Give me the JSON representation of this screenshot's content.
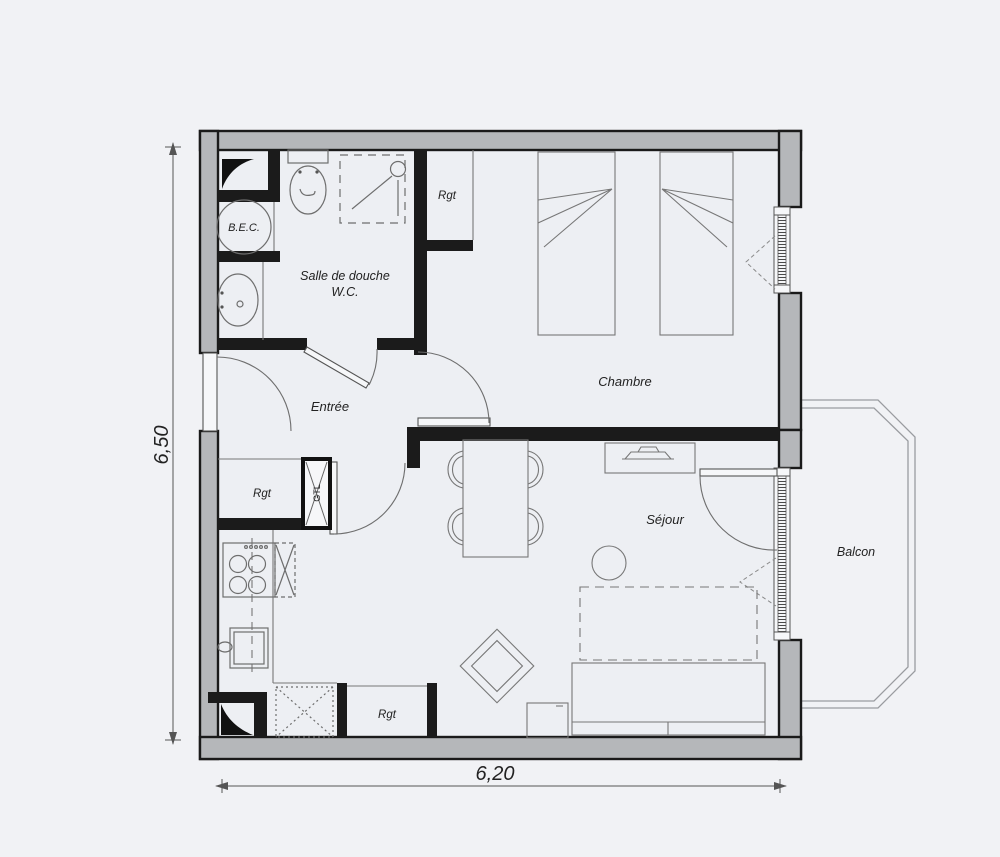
{
  "rooms": {
    "salle_de_douche": {
      "line1": "Salle de douche",
      "line2": "W.C."
    },
    "entree": {
      "label": "Entrée"
    },
    "chambre": {
      "label": "Chambre"
    },
    "sejour": {
      "label": "Séjour"
    },
    "balcon": {
      "label": "Balcon"
    }
  },
  "fixtures": {
    "bec_label": "B.E.C.",
    "gtl_label": "GTL"
  },
  "storage": {
    "rgt_bathroom": "Rgt",
    "rgt_kitchen": "Rgt",
    "rgt_living": "Rgt"
  },
  "dimensions": {
    "height_label": "6,50",
    "width_label": "6,20"
  },
  "colors": {
    "paper": "#f1f2f5",
    "interior": "#edeff3",
    "wall_fill": "#b5b7ba",
    "wall_line": "#1a1a1a",
    "furniture_line": "#6e6e6e",
    "text": "#222222"
  }
}
